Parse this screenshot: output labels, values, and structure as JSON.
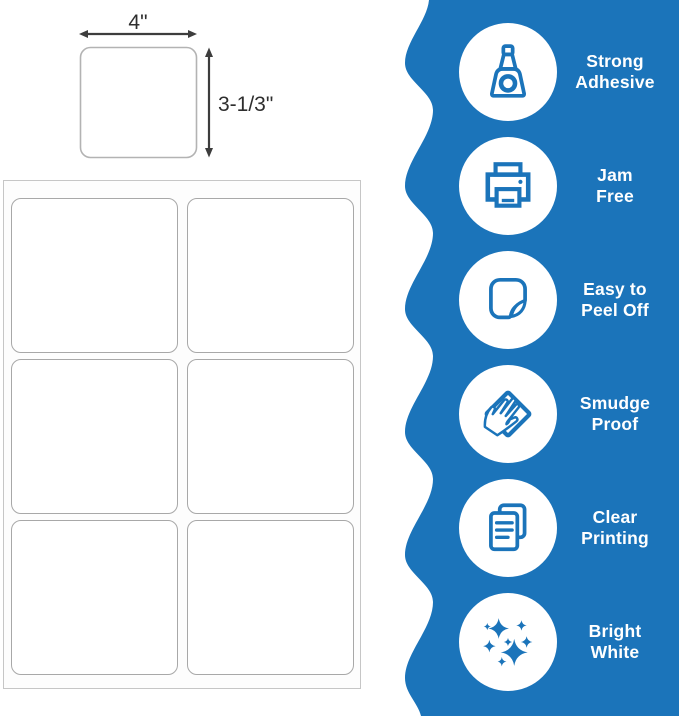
{
  "product_diagram": {
    "width_label": "4\"",
    "height_label": "3-1/3\"",
    "sheet_columns": 2,
    "sheet_rows": 3,
    "labels_per_sheet": 6
  },
  "features": [
    {
      "icon": "glue-bottle-icon",
      "lines": [
        "Strong",
        "Adhesive"
      ]
    },
    {
      "icon": "printer-icon",
      "lines": [
        "Jam",
        "Free"
      ]
    },
    {
      "icon": "peel-sticker-icon",
      "lines": [
        "Easy to",
        "Peel Off"
      ]
    },
    {
      "icon": "smudge-hand-icon",
      "lines": [
        "Smudge",
        "Proof"
      ]
    },
    {
      "icon": "documents-icon",
      "lines": [
        "Clear",
        "Printing"
      ]
    },
    {
      "icon": "sparkles-icon",
      "lines": [
        "Bright",
        "White"
      ]
    }
  ],
  "colors": {
    "banner_blue": "#1b74ba",
    "icon_blue": "#1b74ba",
    "feature_text": "#ffffff",
    "dimension_text": "#2e2e2e",
    "arrow": "#3d3d3d",
    "diagram_label_border": "#b3b3b3",
    "sheet_border": "#c6c6c6",
    "label_cell_border": "#a8a8a8"
  }
}
